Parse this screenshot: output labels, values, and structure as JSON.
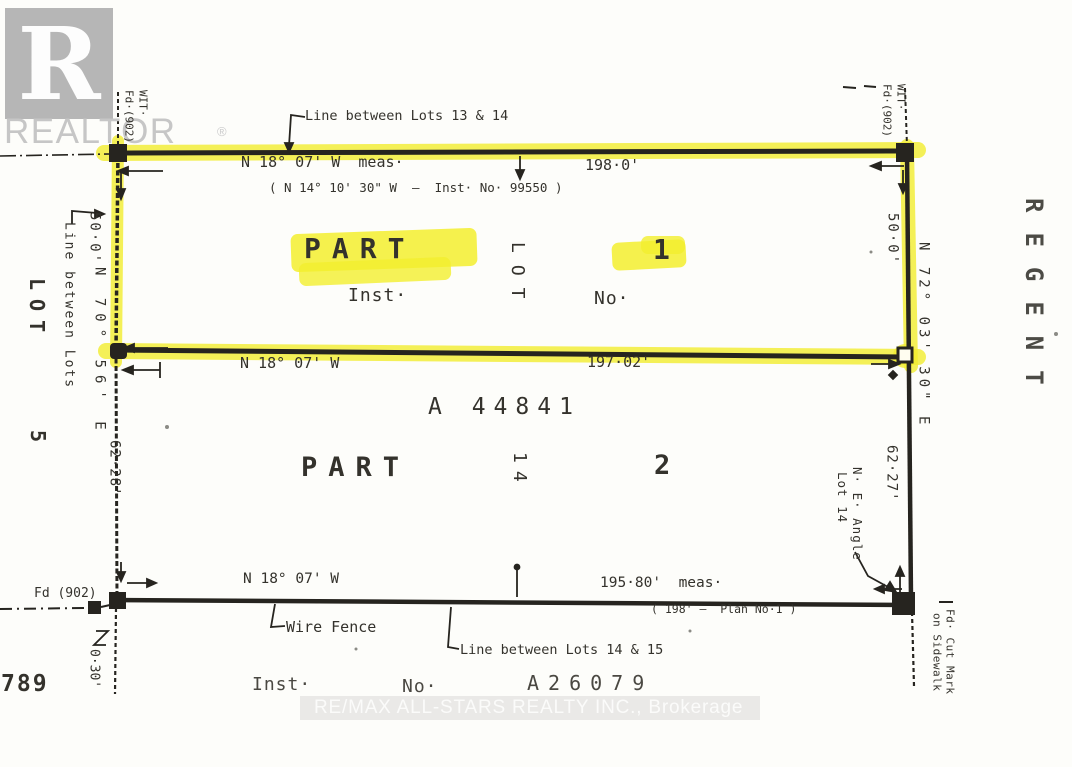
{
  "branding": {
    "logo_letter": "R",
    "logo_wordmark": "REALTOR",
    "logo_reg": "®",
    "watermark": "RE/MAX ALL-STARS REALTY INC., Brokerage"
  },
  "street": {
    "name": "REGENT",
    "number": "789"
  },
  "north_boundary": {
    "line_label": "Line between Lots 13 & 14",
    "bearing": "N 18° 07' W  meas·",
    "distance": "198·0'",
    "plan_note": "( N 14° 10' 30\" W  —  Inst· No· 99550 )"
  },
  "parcel_part1": {
    "part": "PART",
    "lot_word": "LOT",
    "lot_number": "1",
    "inst_label": "Inst·",
    "no_label": "No·"
  },
  "mid_boundary": {
    "bearing": "N 18° 07' W",
    "distance": "197·02'"
  },
  "parcel_part2": {
    "plan_number": "A 44841",
    "part": "PART",
    "lot_word": "14",
    "lot_number": "2"
  },
  "south_boundary": {
    "bearing": "N 18° 07' W",
    "distance": "195·80'  meas·",
    "plan_note": "( 198' —  Plan No·1 )",
    "fence_label": "Wire Fence",
    "line_label": "Line between Lots 14 & 15",
    "inst_label": "Inst·",
    "no_label": "No·",
    "inst_number": "A26079"
  },
  "west_boundary": {
    "line_label": "Line between Lots",
    "lot_word": "LOT",
    "lot_number": "5",
    "seg1": "50·0'",
    "bearing": "N 70° 56' E",
    "seg2": "62·28'",
    "monument": "Fd (902)",
    "offset": "0·30'",
    "wit1": "WIT·",
    "wit2": "Fd·(902)"
  },
  "east_boundary": {
    "seg1": "50·0'",
    "bearing": "N 72° 03' 30\" E",
    "seg2": "62·27'",
    "corner_label_1": "N· E· Angle",
    "corner_label_2": "Lot 14",
    "wit1": "WIT·",
    "wit2": "Fd·(902)",
    "sidewalk_1": "Fd· Cut Mark",
    "sidewalk_2": "on Sidewalk"
  },
  "colors": {
    "highlight": "#f1ed33",
    "ink": "#26241f"
  }
}
